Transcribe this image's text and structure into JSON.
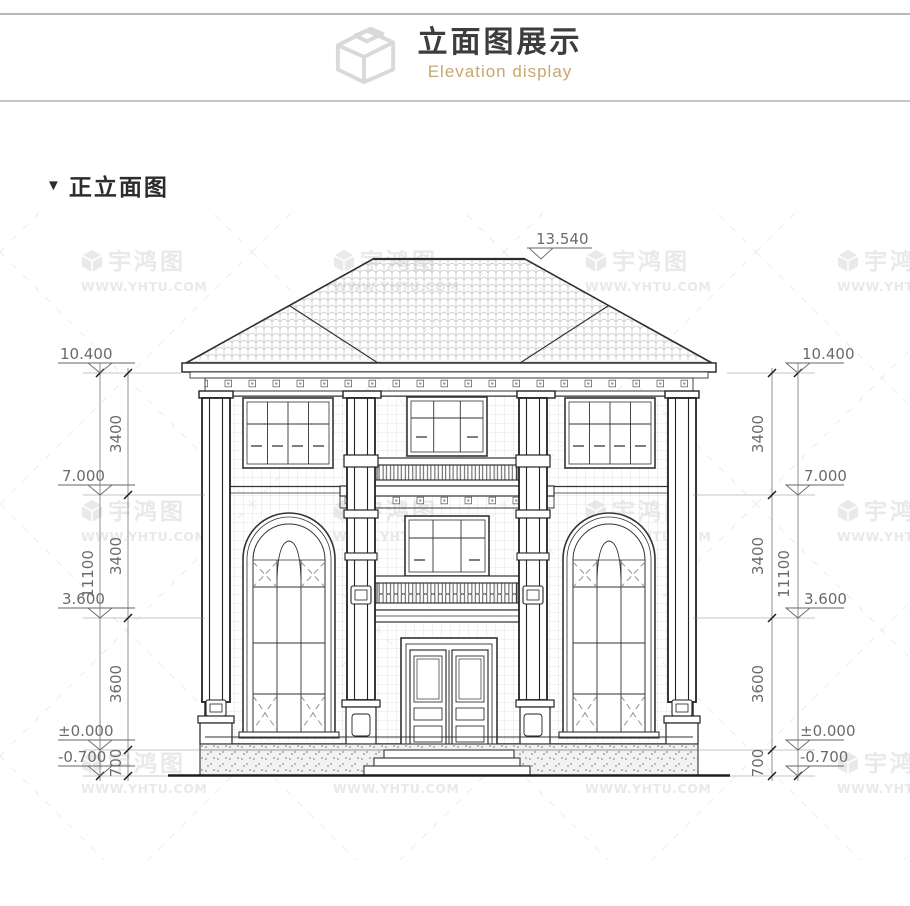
{
  "header": {
    "title": "立面图展示",
    "subtitle": "Elevation display"
  },
  "section": {
    "marker": "▼",
    "title": "正立面图"
  },
  "watermark": {
    "name": "宇鸿图",
    "url": "WWW.YHTU.COM"
  },
  "elevation_markers": {
    "ridge": "13.540",
    "eave": "10.400",
    "floor3": "7.000",
    "floor2": "3.600",
    "zero": "±0.000",
    "grade": "-0.700"
  },
  "dimensions": {
    "floor3_height": "3400",
    "floor2_height": "3400",
    "floor1_height": "3600",
    "plinth": "700",
    "total": "11100"
  },
  "colors": {
    "accent_gold": "#c5a86f",
    "line_dark": "#2e2e2e",
    "dimension_gray": "#6b6b6b",
    "watermark_gray": "#e9e9e9"
  }
}
